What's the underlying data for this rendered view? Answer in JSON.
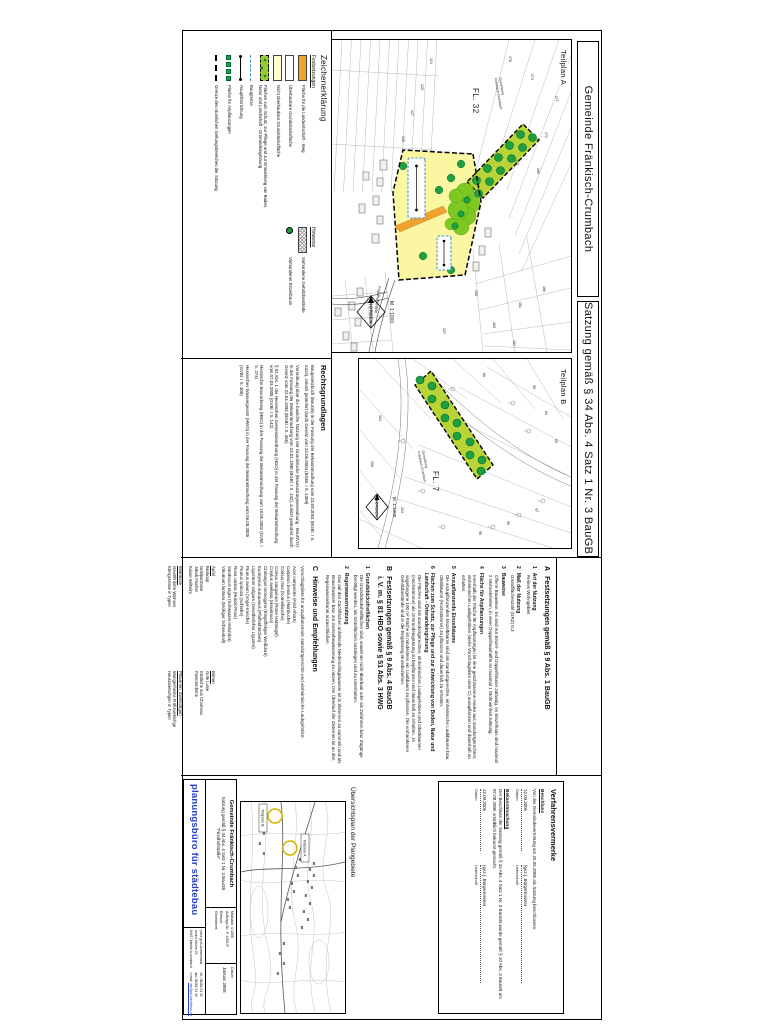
{
  "palette": {
    "accent_blue": "#2440cc",
    "yellow_area": "#fbf6a2",
    "pale_yellow": "#ffffcf",
    "orange": "#f0a22e",
    "bright_green": "#7ec822",
    "band_green": "#b8d437",
    "tree_green": "#1fa03f",
    "baugrenze_blue": "#4a90d9"
  },
  "title_bar": {
    "left": "Gemeinde Fränkisch-Crumbach",
    "right": "Satzung gemäß § 34 Abs. 4 Satz 1 Nr. 3 BauGB \"Friedhofstraße\""
  },
  "plan_a": {
    "label": "Teilplan A",
    "flur": "FL. 32",
    "gemarkung_line1": "Gemarkung",
    "gemarkung_line2": "Fränkisch-Crumbach",
    "street": "Friedhofstraße",
    "north_label": "NORDEN",
    "scale_label": "M. 1:1000",
    "parcels": [
      "171",
      "172",
      "169",
      "174",
      "176",
      "152",
      "160",
      "161",
      "163",
      "164",
      "150",
      "137",
      "124",
      "125",
      "127",
      "128"
    ]
  },
  "plan_b": {
    "label": "Teilplan B",
    "flur": "FL. 7",
    "gemarkung_line1": "Gemarkung",
    "gemarkung_line2": "Fränkisch-Crumbach",
    "north_label": "NORDEN",
    "scale_label": "M. 1:1000",
    "parcels": [
      "58",
      "61",
      "65",
      "66",
      "87",
      "95",
      "96",
      "103",
      "104",
      "106"
    ]
  },
  "legend": {
    "title": "Zeichenerklärung",
    "group_festsetzungen": "Festsetzungen",
    "group_hinweise": "Hinweise",
    "items": [
      {
        "label": "Fläche für die Landwirtschaft - Weg"
      },
      {
        "label": "Überbaubare Grundstücksfläche"
      },
      {
        "label": "Nicht überbaubare Grundstücksfläche"
      },
      {
        "label": "Flächen zum Schutz, zur Pflege und zur Entwicklung von Boden, Natur und Landschaft - Ortsrandeingrünung"
      },
      {
        "label": "Baugrenze"
      },
      {
        "label": "Hauptfirstrichtung"
      },
      {
        "label": "Fläche für Anpflanzungen"
      },
      {
        "label": "Grenze des räumlichen Geltungsbereiches der Satzung"
      },
      {
        "label": "Vorhandene Gehölzbestände"
      },
      {
        "label": "Vorhandener Einzelbaum"
      }
    ]
  },
  "rechtsgrundlagen": {
    "title": "Rechtsgrundlagen",
    "paragraphs": [
      "Baugesetzbuch (BauGB) in der Fassung der Bekanntmachung vom 23.09.2004 (BGBl. I S. 2414), zuletzt geändert durch Gesetz vom 24.06.2004 (BGBl. I S. 1359)",
      "Verordnung über die bauliche Nutzung der Grundstücke (Baunutzungsverordnung - BauNVO) in der Fassung der Bekanntmachung vom 23.01.1990 (BGBl. I S. 132), zuletzt geändert durch Gesetz vom 22.04.1993 (BGBl. I S. 466)",
      "§ 81 Abs. 1 der Hessischen Gemeindeordnung (HGO) in der Fassung der Bekanntmachung vom 07.03.2005 (GVBl. I S. 142)",
      "Hessische Bauordnung (HBO) in der Fassung der Bekanntmachung vom 18.06.2002 (GVBl. I S. 274)",
      "Hessisches Wassergesetz (HWG) in der Fassung der Bekanntmachung vom 06.05.2005 (GVBl. I S. 305)"
    ]
  },
  "section_a": {
    "letter": "A",
    "title": "Festsetzungen gemäß § 9 Abs. 1 BauGB",
    "items": [
      {
        "num": "1",
        "title": "Art der Nutzung",
        "body": "Reines Wohngebiet"
      },
      {
        "num": "2",
        "title": "Maß der Nutzung",
        "body": "Grundflächenzahl (GRZ) 0,3"
      },
      {
        "num": "3",
        "title": "Bauweise",
        "body": "Offene Bauweise. Es sind nur Einzel- und Doppelhäuser zulässig. Im Einzelhaus sind maximal 2 Wohneinheiten, in einer Doppelhaushälfte ist maximal 1 Wohneinheit zulässig."
      },
      {
        "num": "4",
        "title": "Fläche für Anpflanzungen",
        "body": "Innerhalb der Fläche für Anpflanzungen ist eine geschlossene Hecke aus standortgerechten, einheimischen Laubgehölzen (siehe Vorschlagsliste unter C) anzupflanzen und dauerhaft zu erhalten."
      },
      {
        "num": "5",
        "title": "Anzupflanzende Einzelbäume",
        "body": "Die anzupflanzenden Einzelbäume sind als standortgerechte, einheimische Laubbäume bzw. Obstbäume (Hochstämme) zu pflanzen und dauerhaft zu erhalten."
      },
      {
        "num": "6",
        "title": "Flächen zum Schutz, zur Pflege und zur Entwicklung von Boden, Natur und Landschaft - Ortsrandeingrünung",
        "body": "Die Flächen sind mit standortgerechten, einheimischen Laubgehölzen und Obstbäumen (Hochstämme) als Ortsrandeingrünung zu bepflanzen und dauerhaft zu erhalten. Je angefangene 100 m² Fläche ist mindestens ein Laubbaum zu pflanzen. Die vorhandenen Gehölzbestände sind in die Eingrünung einzubeziehen."
      }
    ]
  },
  "section_b": {
    "letter": "B",
    "title_line1": "Festsetzungen gemäß § 9 Abs. 4 BauGB",
    "title_line2": "i. V. m. § 81 HBO sowie § 51 Abs. 3 HWG",
    "items": [
      {
        "num": "1",
        "title": "Grundstücksfreiflächen",
        "body": "Die Grundstücksfreiflächen sind, soweit sie nicht überbaut oder als Zufahrten bzw. Zugänge benötigt werden, als Grünflächen anzulegen und zu unterhalten."
      },
      {
        "num": "2",
        "title": "Regenwassernutzung",
        "body": "Das auf den Dachflächen anfallende Niederschlagswasser ist in Zisternen zu sammeln und als Brauchwasser bzw. zur Gartenbewässerung zu nutzen. Der Überlauf der Zisternen ist an den Regenwasserkanal anzuschließen."
      }
    ]
  },
  "section_c": {
    "letter": "C",
    "title": "Hinweise und Empfehlungen",
    "intro": "Vorschlagsliste für anzupflanzende standortgerechte und einheimische Laubgehölze:",
    "species": [
      "Acer campestre (Feld-Ahorn)",
      "Carpinus betulus (Hainbuche)",
      "Cornus mas (Kornelkirsche)",
      "Cornus sanguinea (Roter Hartriegel)",
      "Corylus avellana (Haselnuss)",
      "Crataegus monogyna (Eingriffeliger Weißdorn)",
      "Euonymus europaeus (Pfaffenhütchen)",
      "Ligustrum vulgare (Gewöhnlicher Liguster)",
      "Prunus avium (Vogel-Kirsche)",
      "Prunus spinosa (Schlehe)",
      "Rosa canina (Hunds-Rose)",
      "Sambucus nigra (Schwarzer Holunder)",
      "Viburnum lantana (Wolliger Schneeball)"
    ],
    "fruit_groups": [
      {
        "title": "Äpfel",
        "entries": [
          "Boskoop",
          "Goldparmäne",
          "Jakob Fischer",
          "Kaiser Wilhelm"
        ]
      },
      {
        "title": "Birnen",
        "entries": [
          "Gute Luise",
          "Köstliche aus Charneux",
          "Pastorenbirne"
        ]
      },
      {
        "title": "Walnüsse",
        "entries": [
          "Gewöhnliche Walnuss",
          "Königsnüsse in Typen"
        ]
      },
      {
        "title": "Pflaumen, Zwetschgen",
        "entries": [
          "Wangenheims Frühzwetschge",
          "Hauszwetschgen in Typen"
        ]
      }
    ]
  },
  "verfahrensvermerke": {
    "title": "Verfahrensvermerke",
    "blocks": [
      {
        "heading": "Beschluss",
        "body": "Von der Gemeindevertretung am 26.06.2006 als Satzung beschlossen.",
        "date": "12.09.2006",
        "date_label": "Datum",
        "signature": "(gez.), Bürgermeister",
        "signature_label": "Unterschrift"
      },
      {
        "heading": "Bekanntmachung",
        "body": "Der Beschluss der Satzung gemäß § 34 Abs. 4 Satz 1 Nr. 3 BauGB wurde gemäß § 10 Abs. 3 BauGB am 07.08.2006 ortsüblich bekannt gemacht.",
        "date": "12.09.2006",
        "date_label": "Datum",
        "signature": "(gez.), Bürgermeister",
        "signature_label": "Unterschrift"
      }
    ]
  },
  "uebersichtsplan": {
    "title": "Übersichtsplan der Plangebiete",
    "label_a": "Teilplan A",
    "label_b": "Teilplan B"
  },
  "title_block": {
    "gemeinde": "Gemeinde Fränkisch-Crumbach",
    "project_line1": "Satzung gemäß § 34 Abs. 4 Satz 1 Nr. 3 BauGB",
    "project_line2": "\"Friedhofstraße\"",
    "massstab_label": "Maßstab:",
    "massstab_value": "1:1000",
    "auftrag_label": "Auftrags-Nr.:",
    "auftrag_value": "F 4266-P",
    "entwurf_label": "Entwurf:",
    "gezeichnet_label": "Gezeichnet:",
    "datum_label": "Datum:",
    "datum_value": "Januar 2006",
    "firm_name": "planungsbüro für städtebau",
    "address_lines": [
      "petra groß-zimmermann",
      "an der bleiche 29",
      "64407 fränkisch-crumbach"
    ],
    "tel_label": "tel.:",
    "tel_value": "06164-51 30",
    "fax_label": "fax:",
    "fax_value": "06164-51 49",
    "mail_label": "e-mail:",
    "mail_value": "info@pb-staedtebau.de"
  }
}
